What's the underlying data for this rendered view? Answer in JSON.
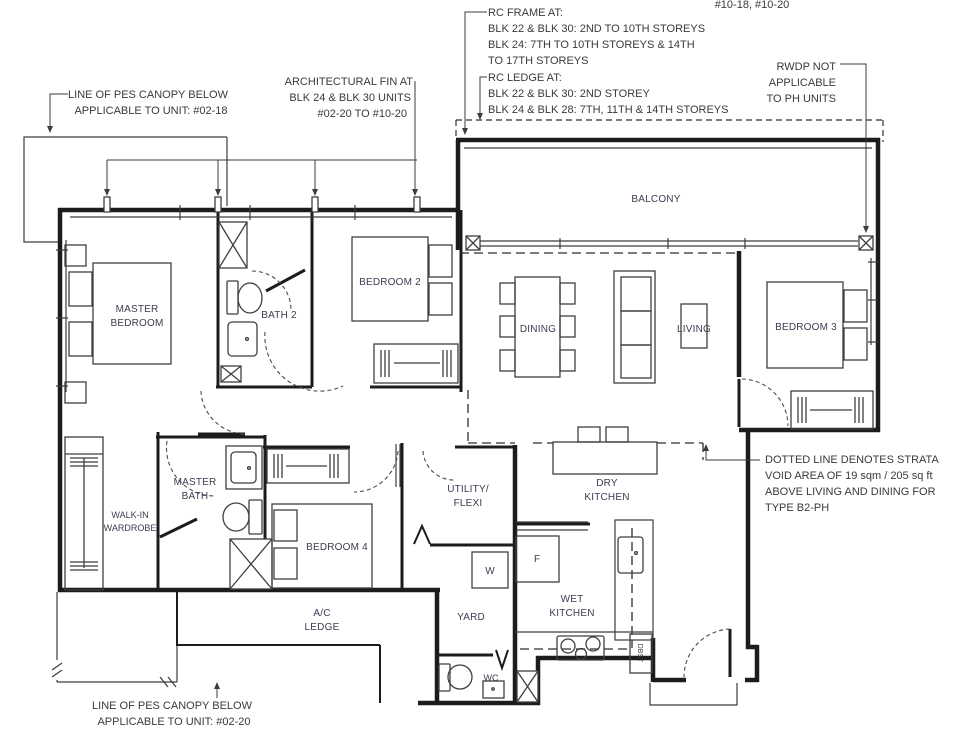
{
  "title": "Unit floor plan",
  "unit_numbers": "#10-18, #10-20",
  "colors": {
    "background": "#ffffff",
    "wall_line": "#1c1c1c",
    "room_label": "#3c3c52",
    "annotation_text": "#3a3a3a"
  },
  "annotations": {
    "rc_frame": [
      "RC FRAME AT:",
      "BLK 22 & BLK 30: 2ND TO 10TH STOREYS",
      "BLK 24: 7TH TO 10TH STOREYS & 14TH",
      "TO 17TH STOREYS"
    ],
    "rc_ledge": [
      "RC LEDGE AT:",
      "BLK 22 & BLK 30: 2ND STOREY",
      "BLK 24 & BLK 28: 7TH, 11TH & 14TH STOREYS"
    ],
    "rwdp": [
      "RWDP NOT",
      "APPLICABLE",
      "TO PH UNITS"
    ],
    "pes_canopy_top": [
      "LINE OF PES CANOPY BELOW",
      "APPLICABLE TO UNIT: #02-18"
    ],
    "architectural_fin": [
      "ARCHITECTURAL FIN AT",
      "BLK 24 & BLK 30 UNITS",
      "#02-20 TO #10-20"
    ],
    "strata_void": [
      "DOTTED LINE DENOTES STRATA",
      "VOID AREA OF 19 sqm / 205 sq ft",
      "ABOVE LIVING AND DINING FOR",
      "TYPE B2-PH"
    ],
    "pes_canopy_bottom": [
      "LINE OF PES CANOPY BELOW",
      "APPLICABLE TO UNIT: #02-20"
    ]
  },
  "rooms": {
    "master_bedroom": [
      "MASTER",
      "BEDROOM"
    ],
    "bath_2": "BATH 2",
    "bedroom_2": "BEDROOM 2",
    "dining": "DINING",
    "living": "LIVING",
    "bedroom_3": "BEDROOM 3",
    "balcony": "BALCONY",
    "walk_in_wardrobe": [
      "WALK-IN",
      "WARDROBE"
    ],
    "master_bath": [
      "MASTER",
      "BATH"
    ],
    "bedroom_4": "BEDROOM 4",
    "utility_flexi": [
      "UTILITY/",
      "FLEXI"
    ],
    "dry_kitchen": [
      "DRY",
      "KITCHEN"
    ],
    "wet_kitchen": [
      "WET",
      "KITCHEN"
    ],
    "yard": "YARD",
    "ac_ledge": [
      "A/C",
      "LEDGE"
    ],
    "wc": "WC"
  },
  "fixtures": {
    "washer": "W",
    "fridge": "F",
    "refuse_chute": "DBST"
  }
}
